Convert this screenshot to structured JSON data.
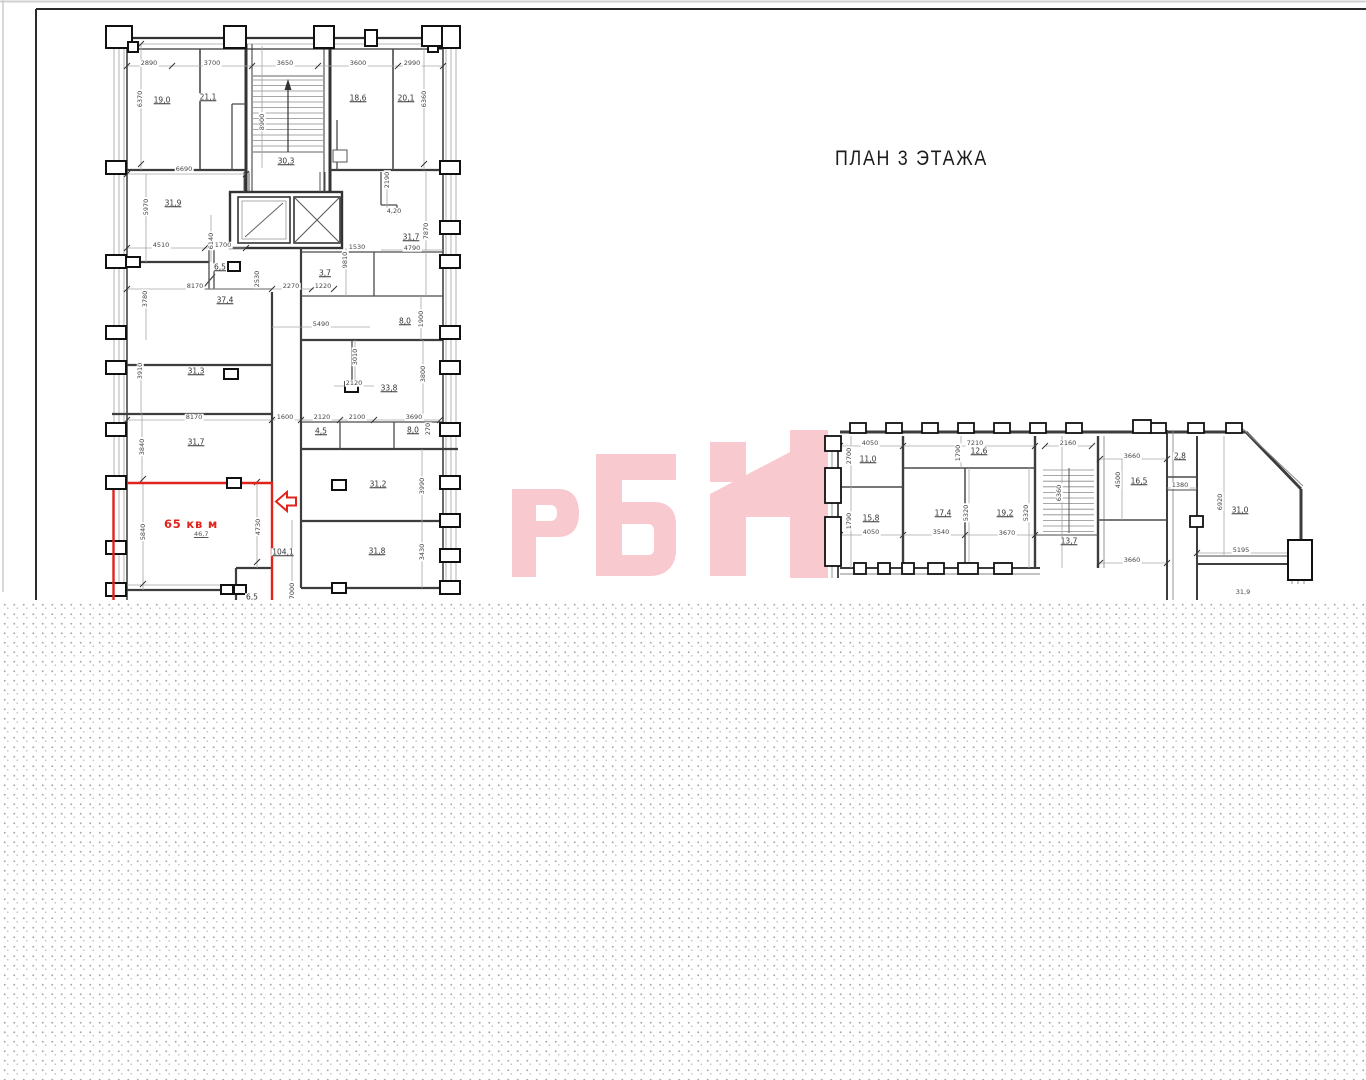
{
  "title": "ПЛАН 3 ЭТАЖА",
  "watermark": "РБН",
  "colors": {
    "highlight": "#e0241c",
    "watermark": "#f9c9d0",
    "walls": "#3d3d3d"
  },
  "highlight": {
    "label": "65 кв м",
    "area": "46,7"
  },
  "plans": {
    "left": {
      "room_labels": [
        {
          "t": "19,0",
          "x": 162,
          "y": 100
        },
        {
          "t": "21,1",
          "x": 208,
          "y": 97
        },
        {
          "t": "30,3",
          "x": 286,
          "y": 161
        },
        {
          "t": "18,6",
          "x": 358,
          "y": 98
        },
        {
          "t": "20,1",
          "x": 406,
          "y": 98
        },
        {
          "t": "31,9",
          "x": 173,
          "y": 203
        },
        {
          "t": "6,5",
          "x": 220,
          "y": 267
        },
        {
          "t": "3,7",
          "x": 325,
          "y": 273
        },
        {
          "t": "31,7",
          "x": 411,
          "y": 237
        },
        {
          "t": "37,4",
          "x": 225,
          "y": 300
        },
        {
          "t": "8,0",
          "x": 405,
          "y": 321
        },
        {
          "t": "31,3",
          "x": 196,
          "y": 371
        },
        {
          "t": "33,8",
          "x": 389,
          "y": 388
        },
        {
          "t": "4,5",
          "x": 321,
          "y": 431
        },
        {
          "t": "8,0",
          "x": 413,
          "y": 430
        },
        {
          "t": "31,7",
          "x": 196,
          "y": 442
        },
        {
          "t": "31,2",
          "x": 378,
          "y": 484
        },
        {
          "t": "104,1",
          "x": 283,
          "y": 552
        },
        {
          "t": "31,8",
          "x": 377,
          "y": 551
        },
        {
          "t": "6,5",
          "x": 252,
          "y": 597
        }
      ],
      "dim_labels": [
        {
          "t": "2890",
          "x": 149,
          "y": 63
        },
        {
          "t": "3700",
          "x": 212,
          "y": 63
        },
        {
          "t": "3650",
          "x": 285,
          "y": 63
        },
        {
          "t": "3600",
          "x": 358,
          "y": 63
        },
        {
          "t": "2990",
          "x": 412,
          "y": 63
        },
        {
          "t": "6370",
          "x": 140,
          "y": 99,
          "v": true
        },
        {
          "t": "8900",
          "x": 262,
          "y": 122,
          "v": true
        },
        {
          "t": "6360",
          "x": 424,
          "y": 99,
          "v": true
        },
        {
          "t": "6690",
          "x": 184,
          "y": 169
        },
        {
          "t": "5970",
          "x": 146,
          "y": 207,
          "v": true
        },
        {
          "t": "4510",
          "x": 161,
          "y": 245
        },
        {
          "t": "6140",
          "x": 211,
          "y": 241,
          "v": true
        },
        {
          "t": "1700",
          "x": 223,
          "y": 245
        },
        {
          "t": "2190",
          "x": 387,
          "y": 180,
          "v": true
        },
        {
          "t": "4,20",
          "x": 394,
          "y": 211
        },
        {
          "t": "7870",
          "x": 426,
          "y": 231,
          "v": true
        },
        {
          "t": "4790",
          "x": 412,
          "y": 248
        },
        {
          "t": "1530",
          "x": 357,
          "y": 247
        },
        {
          "t": "9810",
          "x": 345,
          "y": 260,
          "v": true
        },
        {
          "t": "2530",
          "x": 257,
          "y": 279,
          "v": true
        },
        {
          "t": "8170",
          "x": 195,
          "y": 286
        },
        {
          "t": "2270",
          "x": 291,
          "y": 286
        },
        {
          "t": "1220",
          "x": 323,
          "y": 286
        },
        {
          "t": "3780",
          "x": 145,
          "y": 299,
          "v": true
        },
        {
          "t": "1900",
          "x": 421,
          "y": 319,
          "v": true
        },
        {
          "t": "5490",
          "x": 321,
          "y": 324
        },
        {
          "t": "3910",
          "x": 140,
          "y": 371,
          "v": true
        },
        {
          "t": "3010",
          "x": 355,
          "y": 357,
          "v": true
        },
        {
          "t": "3800",
          "x": 423,
          "y": 374,
          "v": true
        },
        {
          "t": "2120",
          "x": 354,
          "y": 383
        },
        {
          "t": "8170",
          "x": 194,
          "y": 417
        },
        {
          "t": "1600",
          "x": 285,
          "y": 417
        },
        {
          "t": "2120",
          "x": 322,
          "y": 417
        },
        {
          "t": "2100",
          "x": 357,
          "y": 417
        },
        {
          "t": "3690",
          "x": 414,
          "y": 417
        },
        {
          "t": "270",
          "x": 428,
          "y": 429,
          "v": true
        },
        {
          "t": "3840",
          "x": 142,
          "y": 447,
          "v": true
        },
        {
          "t": "3990",
          "x": 422,
          "y": 486,
          "v": true
        },
        {
          "t": "5840",
          "x": 143,
          "y": 532,
          "v": true
        },
        {
          "t": "4730",
          "x": 258,
          "y": 527,
          "v": true
        },
        {
          "t": "3430",
          "x": 422,
          "y": 552,
          "v": true
        },
        {
          "t": "7000",
          "x": 292,
          "y": 591,
          "v": true
        }
      ]
    },
    "right": {
      "room_labels": [
        {
          "t": "11,0",
          "x": 868,
          "y": 459
        },
        {
          "t": "12,6",
          "x": 979,
          "y": 451
        },
        {
          "t": "15,8",
          "x": 871,
          "y": 518
        },
        {
          "t": "17,4",
          "x": 943,
          "y": 513
        },
        {
          "t": "19,2",
          "x": 1005,
          "y": 513
        },
        {
          "t": "13,7",
          "x": 1069,
          "y": 541
        },
        {
          "t": "16,5",
          "x": 1139,
          "y": 481
        },
        {
          "t": "2,8",
          "x": 1180,
          "y": 456
        },
        {
          "t": "31,0",
          "x": 1240,
          "y": 510
        }
      ],
      "dim_labels": [
        {
          "t": "4050",
          "x": 870,
          "y": 443
        },
        {
          "t": "7210",
          "x": 975,
          "y": 443
        },
        {
          "t": "2160",
          "x": 1068,
          "y": 443
        },
        {
          "t": "2700",
          "x": 849,
          "y": 456,
          "v": true
        },
        {
          "t": "1790",
          "x": 958,
          "y": 453,
          "v": true
        },
        {
          "t": "3660",
          "x": 1132,
          "y": 456
        },
        {
          "t": "1380",
          "x": 1180,
          "y": 485
        },
        {
          "t": "4500",
          "x": 1118,
          "y": 480,
          "v": true
        },
        {
          "t": "6360",
          "x": 1059,
          "y": 493,
          "v": true
        },
        {
          "t": "1790",
          "x": 849,
          "y": 521,
          "v": true
        },
        {
          "t": "5320",
          "x": 966,
          "y": 513,
          "v": true
        },
        {
          "t": "5320",
          "x": 1026,
          "y": 513,
          "v": true
        },
        {
          "t": "6920",
          "x": 1220,
          "y": 502,
          "v": true
        },
        {
          "t": "4050",
          "x": 871,
          "y": 532
        },
        {
          "t": "3540",
          "x": 941,
          "y": 532
        },
        {
          "t": "3670",
          "x": 1007,
          "y": 533
        },
        {
          "t": "5195",
          "x": 1241,
          "y": 550
        },
        {
          "t": "3660",
          "x": 1132,
          "y": 560
        },
        {
          "t": "31,9",
          "x": 1243,
          "y": 592
        }
      ]
    }
  }
}
